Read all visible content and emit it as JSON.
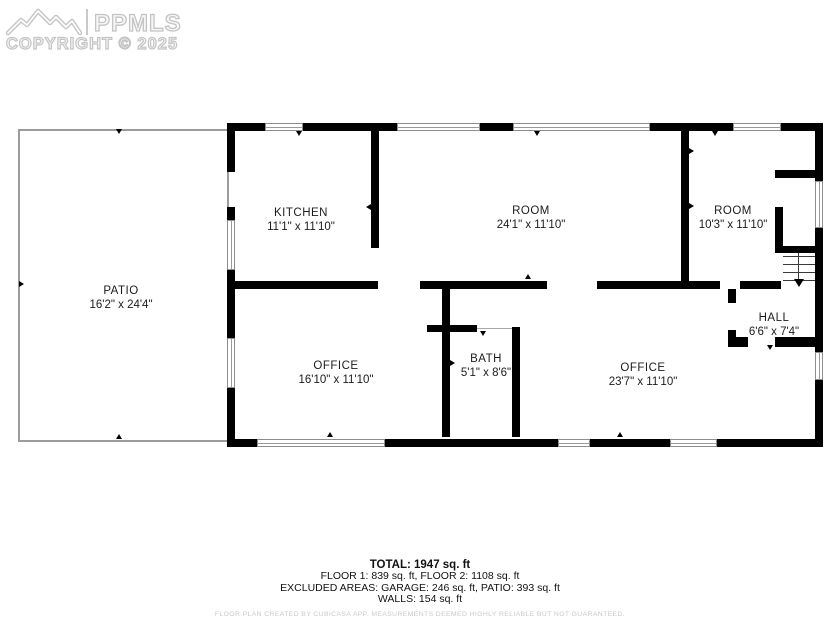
{
  "watermark": {
    "brand": "PPMLS",
    "copyright": "COPYRIGHT © 2025"
  },
  "rooms": [
    {
      "name": "PATIO",
      "dims": "16'2\" x 24'4\""
    },
    {
      "name": "KITCHEN",
      "dims": "11'1\" x 11'10\""
    },
    {
      "name": "ROOM",
      "dims": "24'1\" x 11'10\""
    },
    {
      "name": "ROOM",
      "dims": "10'3\" x 11'10\""
    },
    {
      "name": "HALL",
      "dims": "6'6\" x 7'4\""
    },
    {
      "name": "OFFICE",
      "dims": "16'10\" x 11'10\""
    },
    {
      "name": "BATH",
      "dims": "5'1\" x 8'6\""
    },
    {
      "name": "OFFICE",
      "dims": "23'7\" x 11'10\""
    }
  ],
  "summary": {
    "total": "TOTAL: 1947 sq. ft",
    "floors": "FLOOR 1: 839 sq. ft, FLOOR 2: 1108 sq. ft",
    "excluded": "EXCLUDED AREAS: GARAGE: 246 sq. ft, PATIO: 393 sq. ft",
    "walls": "WALLS: 154 sq. ft",
    "disclaimer": "FLOOR PLAN CREATED BY CUBICASA APP. MEASUREMENTS DEEMED HIGHLY RELIABLE BUT NOT GUARANTEED."
  },
  "colors": {
    "wall": "#000000",
    "patio_outline": "#9c9c9c",
    "watermark": "#c4c4c4",
    "disclaimer_text": "#c9c9c9"
  }
}
